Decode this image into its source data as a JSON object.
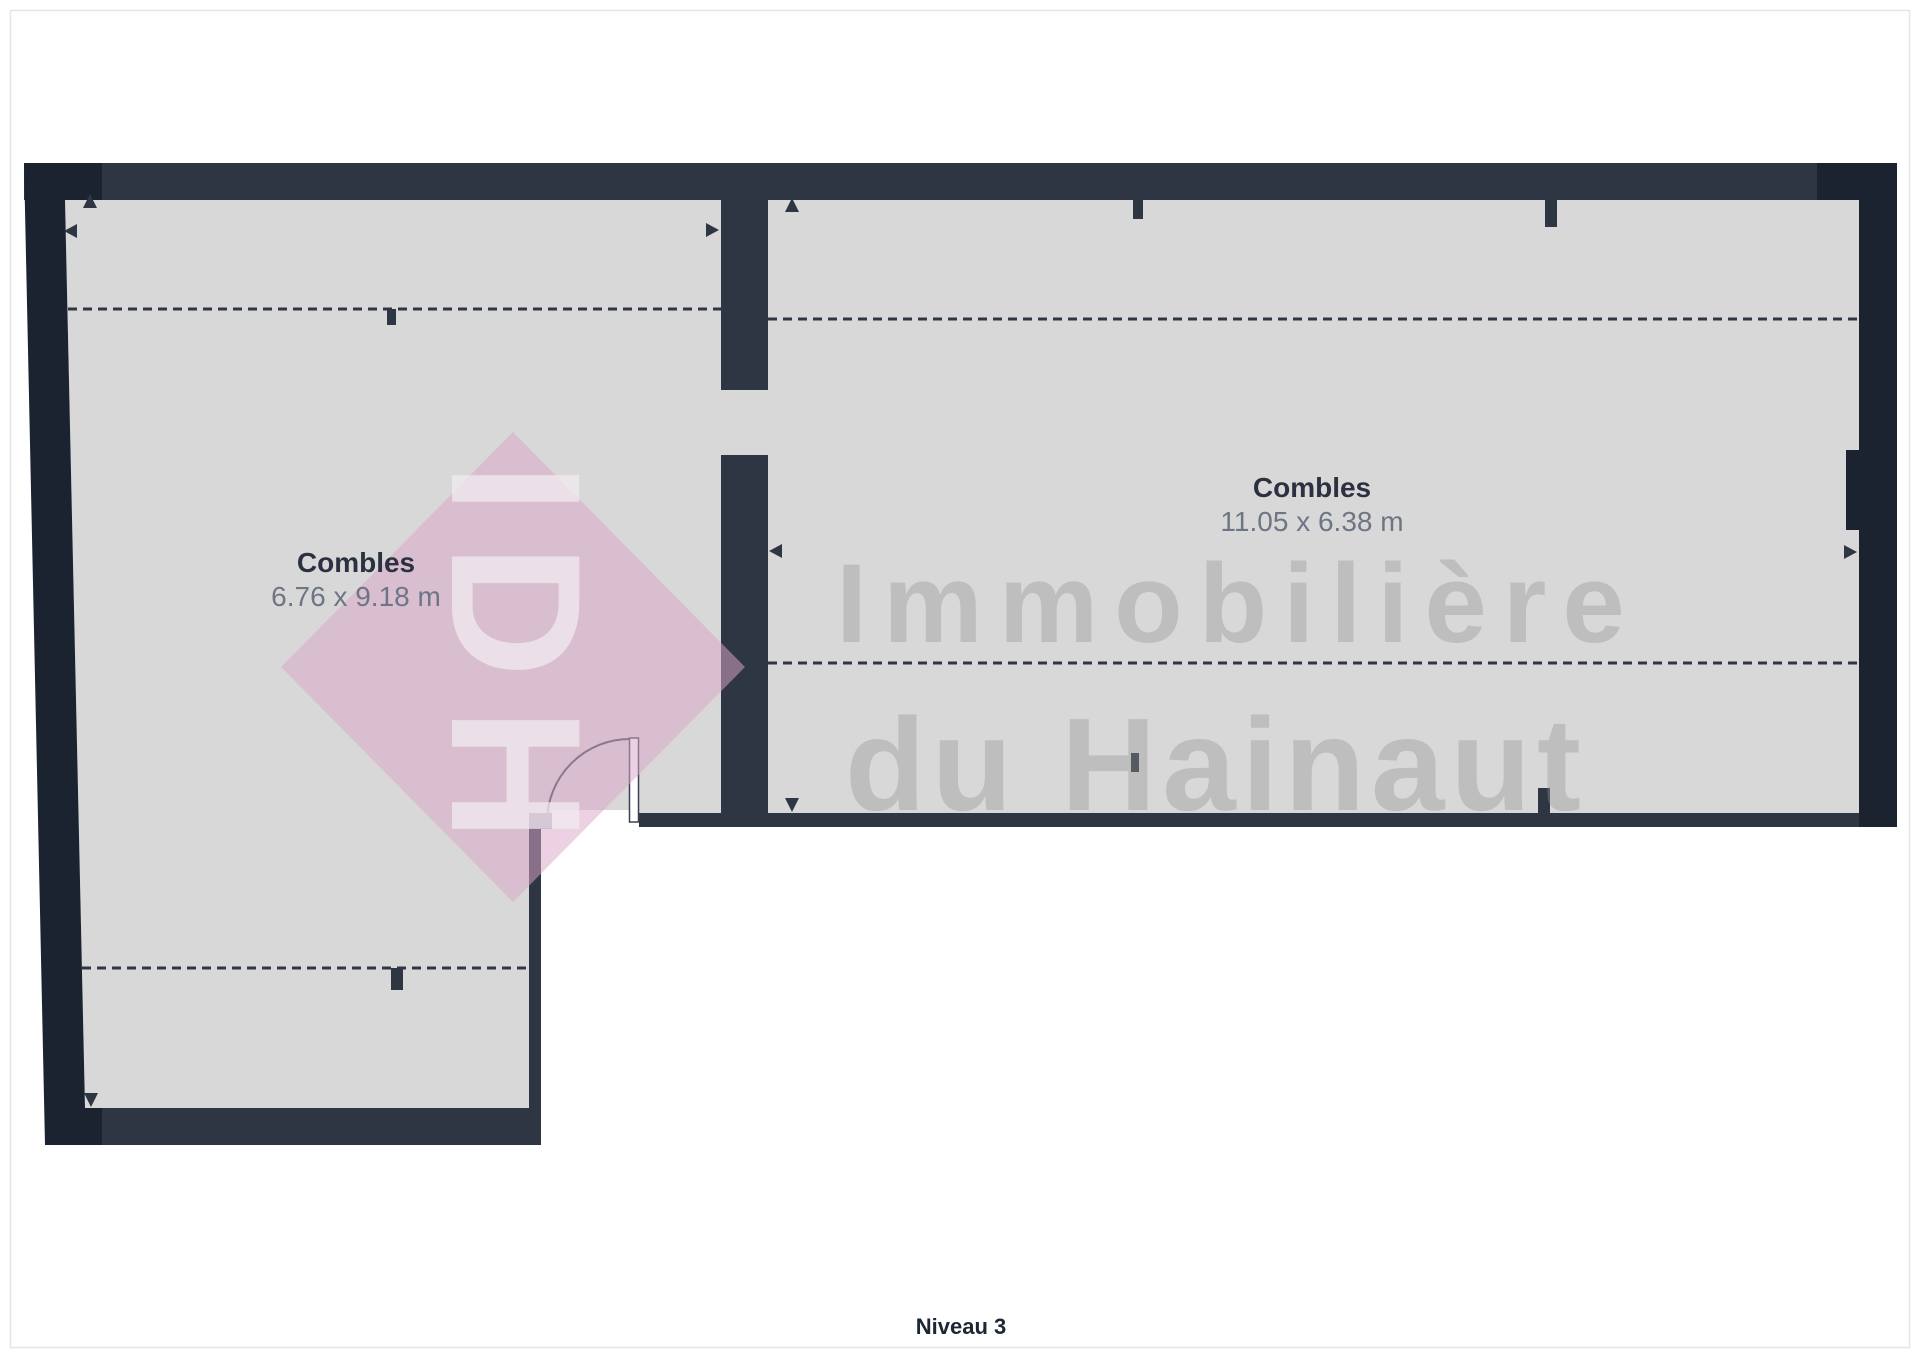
{
  "plan": {
    "level_label": "Niveau 3",
    "rooms": [
      {
        "name": "Combles",
        "dimensions": "6.76 x 9.18 m"
      },
      {
        "name": "Combles",
        "dimensions": "11.05 x 6.38 m"
      }
    ],
    "watermark": {
      "logo_text": "IDH",
      "line1": "Immobilière",
      "line2": "du Hainaut"
    },
    "colors": {
      "wall": "#2e3644",
      "wall_dark": "#1b2230",
      "floor": "#d8d8d8",
      "watermark_pink": "#daa6c9",
      "room_name_text": "#2b3140",
      "dims_text": "#6e7585",
      "level_text": "#1d2634"
    }
  }
}
